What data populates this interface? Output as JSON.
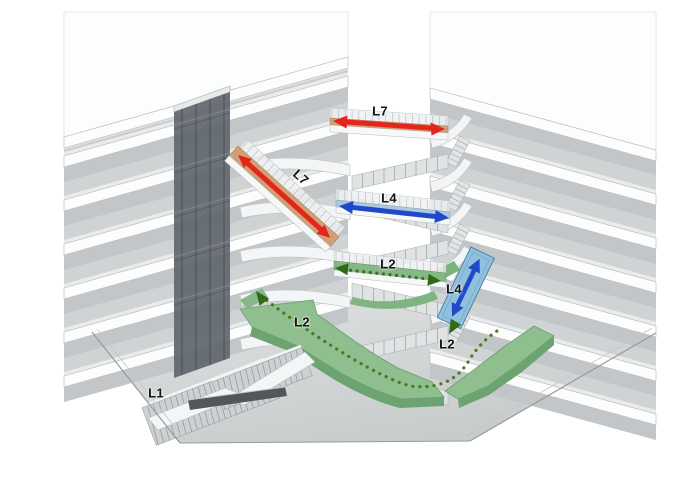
{
  "diagram": {
    "type": "axonometric-building-circulation-diagram",
    "route_labels": {
      "l7_upper_bridge": "L7",
      "l7_diagonal_bridge": "L7",
      "l4_bridge": "L4",
      "l4_escalator": "L4",
      "l2_bridge": "L2",
      "l2_left_walkway": "L2",
      "l2_right_walkway": "L2",
      "l1_grand_stair": "L1"
    },
    "colors": {
      "level7_route_arrow": "#e3251c",
      "level7_bridge_deck": "#cfa075",
      "level4_route_arrow": "#2148c8",
      "level4_escalator_panel": "#8fc0de",
      "level4_bridge_deck": "#abc9e0",
      "level2_route_dots": "#3f7020",
      "level2_walkway_surface": "#8fbe8f",
      "ground_plane": "#d6d9d9",
      "floor_plate_edge": "#fdfdfd",
      "elevator_core_glass": "#5a6167"
    }
  }
}
